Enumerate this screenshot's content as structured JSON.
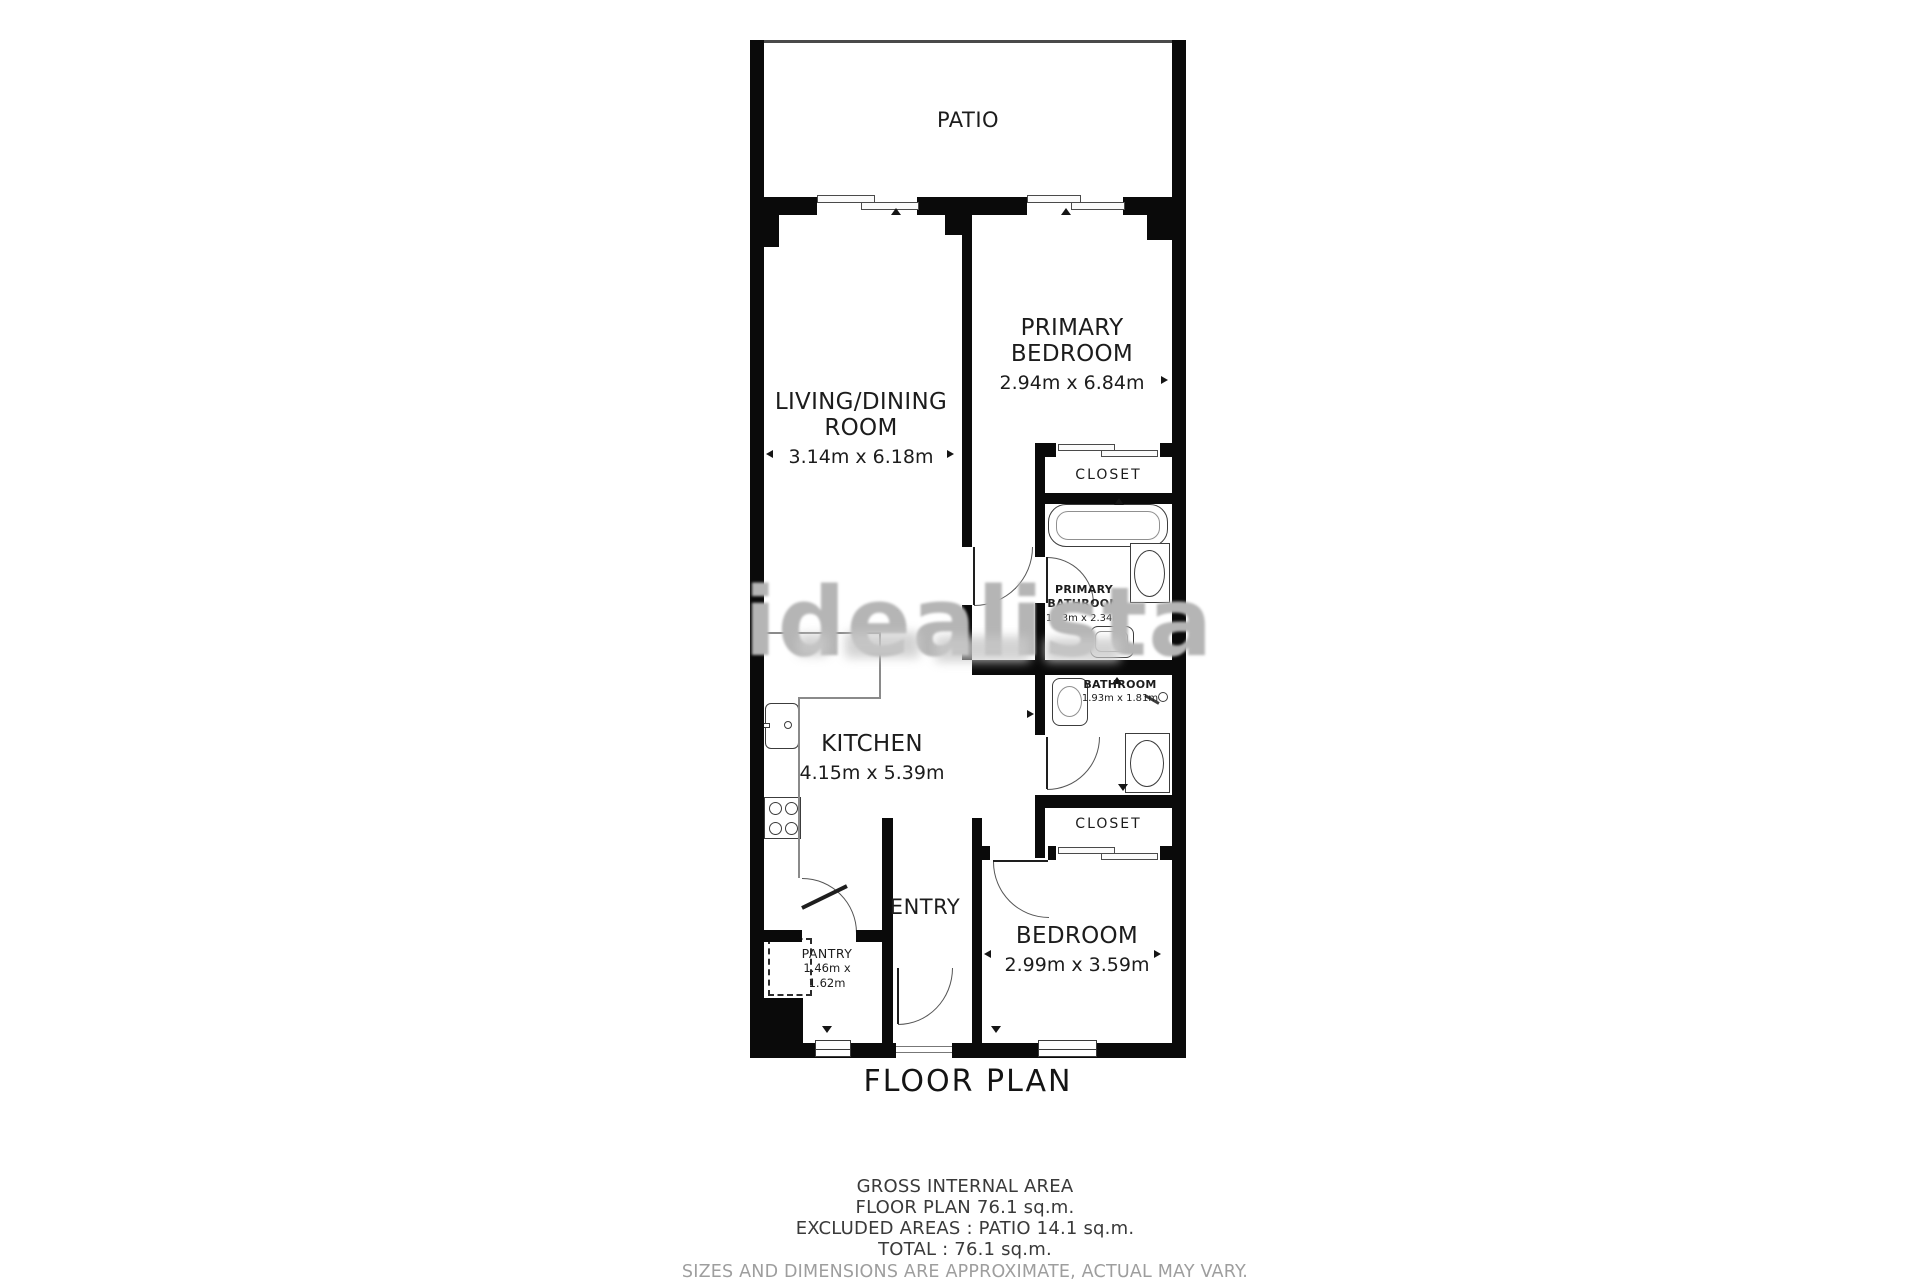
{
  "title": "FLOOR PLAN",
  "watermark": "idealista",
  "rooms": {
    "patio": {
      "name": "PATIO"
    },
    "living_dining": {
      "name": "LIVING/DINING ROOM",
      "dims": "3.14m x 6.18m"
    },
    "primary_bedroom": {
      "name": "PRIMARY BEDROOM",
      "dims": "2.94m x 6.84m"
    },
    "closet_top": {
      "name": "CLOSET"
    },
    "primary_bathroom": {
      "name": "PRIMARY BATHROOM",
      "dims": "1.93m x 2.34m"
    },
    "bathroom": {
      "name": "BATHROOM",
      "dims": "1.93m x 1.81m"
    },
    "closet_bottom": {
      "name": "CLOSET"
    },
    "kitchen": {
      "name": "KITCHEN",
      "dims": "4.15m x 5.39m"
    },
    "entry": {
      "name": "ENTRY"
    },
    "pantry": {
      "name": "PANTRY",
      "dims": "1.46m x 1.62m"
    },
    "bedroom": {
      "name": "BEDROOM",
      "dims": "2.99m x 3.59m"
    }
  },
  "summary": {
    "lines": [
      "GROSS INTERNAL AREA",
      "FLOOR PLAN 76.1 sq.m.",
      "EXCLUDED AREAS :  PATIO 14.1 sq.m.",
      "TOTAL :  76.1 sq.m."
    ],
    "disclaimer": "SIZES AND DIMENSIONS ARE APPROXIMATE, ACTUAL MAY VARY."
  },
  "colors": {
    "walls": "#0a0a0a",
    "label_text": "#1c1c1c",
    "summary_text": "#3a3a3a",
    "disclaimer_text": "#9e9e9e",
    "watermark": "#b5b5b5"
  },
  "icons": [
    "bathtub",
    "toilet",
    "sink",
    "shower",
    "stove",
    "kitchen-sink",
    "sliding-door",
    "door-arc",
    "window",
    "dimension-arrow",
    "pantry-unit"
  ]
}
